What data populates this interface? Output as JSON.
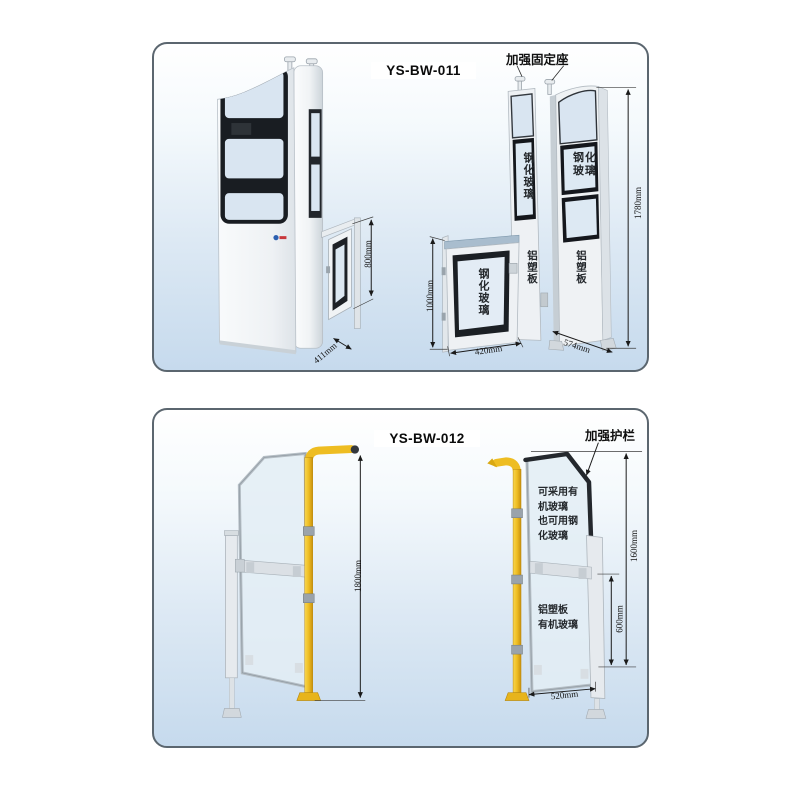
{
  "colors": {
    "accent_yellow": "#eebd22",
    "glass_blue": "#d9e5f1",
    "frame_black": "#1a1d22",
    "panel_bg_bottom": "#c6daed",
    "dim_line": "#1a1a1a"
  },
  "panel1": {
    "model": "YS-BW-011",
    "callout": "加强固定座",
    "labels": {
      "tempered_glass": "钢化玻璃",
      "tempered_glass_l1": "钢化",
      "tempered_glass_l2": "玻璃",
      "alu_board": "铝塑板"
    },
    "dims": {
      "gate_height": "800mm",
      "gate_depth": "411mm",
      "door_height": "1000mm",
      "door_width": "420mm",
      "panel_width": "574mm",
      "total_height": "1780mm"
    }
  },
  "panel2": {
    "model": "YS-BW-012",
    "callout": "加强护栏",
    "glass_note": [
      "可采用有",
      "机玻璃",
      "也可用钢",
      "化玻璃"
    ],
    "lower_note": [
      "铝塑板",
      "有机玻璃"
    ],
    "dims": {
      "total_height": "1800mm",
      "gate_height": "1600mm",
      "lower_height": "600mm",
      "gate_width": "520mm"
    }
  }
}
